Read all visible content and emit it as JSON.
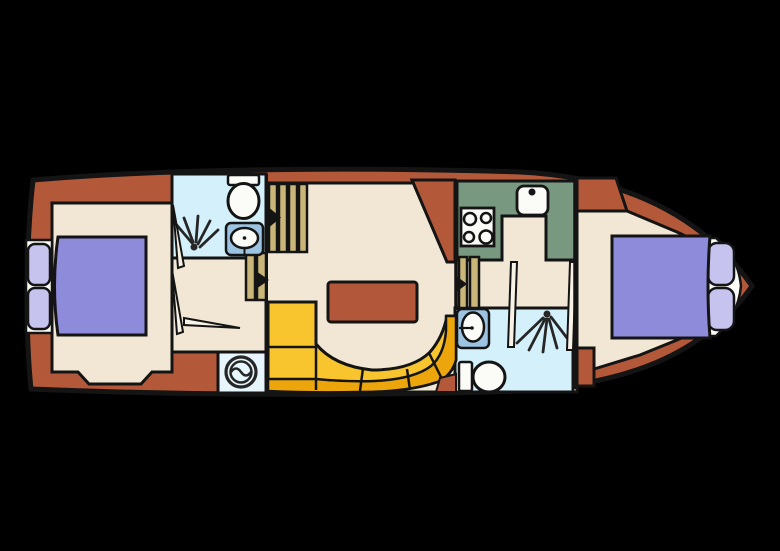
{
  "canvas": {
    "width": 780,
    "height": 551,
    "background": "#000000"
  },
  "palette": {
    "hull": "#b3593a",
    "floor": "#f2e7d5",
    "bathroom": "#d4f0fa",
    "laundry": "#e6f6fc",
    "sink_box": "#9cc3e1",
    "galley": "#78997f",
    "stairs": "#c9b678",
    "sofa_seat": "#f9c52e",
    "sofa_back": "#eca50a",
    "bed": "#8f8bdb",
    "pillow": "#c7c3ef",
    "fixture_white": "#fbfbf8",
    "table": "#b3573a",
    "line": "#141414",
    "icon_dark": "#262626"
  },
  "rooms": [
    {
      "name": "aft-cabin",
      "type": "cabin"
    },
    {
      "name": "aft-bathroom",
      "type": "bathroom"
    },
    {
      "name": "corridor",
      "type": "hallway"
    },
    {
      "name": "laundry-nook",
      "type": "utility"
    },
    {
      "name": "saloon",
      "type": "living"
    },
    {
      "name": "galley",
      "type": "kitchen"
    },
    {
      "name": "fwd-bathroom",
      "type": "bathroom"
    },
    {
      "name": "fwd-cabin",
      "type": "cabin"
    }
  ],
  "fixtures": [
    {
      "name": "double-bed-aft",
      "icon": "bed-icon"
    },
    {
      "name": "double-bed-fwd",
      "icon": "bed-icon"
    },
    {
      "name": "toilet-aft",
      "icon": "toilet-icon"
    },
    {
      "name": "toilet-fwd",
      "icon": "toilet-icon"
    },
    {
      "name": "washbasin-aft",
      "icon": "sink-icon"
    },
    {
      "name": "washbasin-fwd",
      "icon": "sink-icon"
    },
    {
      "name": "shower-aft",
      "icon": "shower-spray-icon"
    },
    {
      "name": "shower-fwd",
      "icon": "shower-spray-icon"
    },
    {
      "name": "washing-machine",
      "icon": "washing-machine-icon"
    },
    {
      "name": "cooktop",
      "icon": "stove-4-burner-icon"
    },
    {
      "name": "galley-sink",
      "icon": "kitchen-sink-icon"
    },
    {
      "name": "dining-table",
      "icon": "table"
    },
    {
      "name": "curved-sofa",
      "icon": "bench-seat"
    },
    {
      "name": "companionway-main",
      "icon": "stairs-icon"
    },
    {
      "name": "steps-aft",
      "icon": "stairs-icon"
    },
    {
      "name": "steps-fwd",
      "icon": "stairs-icon"
    },
    {
      "name": "walk-direction",
      "icon": "arrow-right-icon"
    }
  ]
}
